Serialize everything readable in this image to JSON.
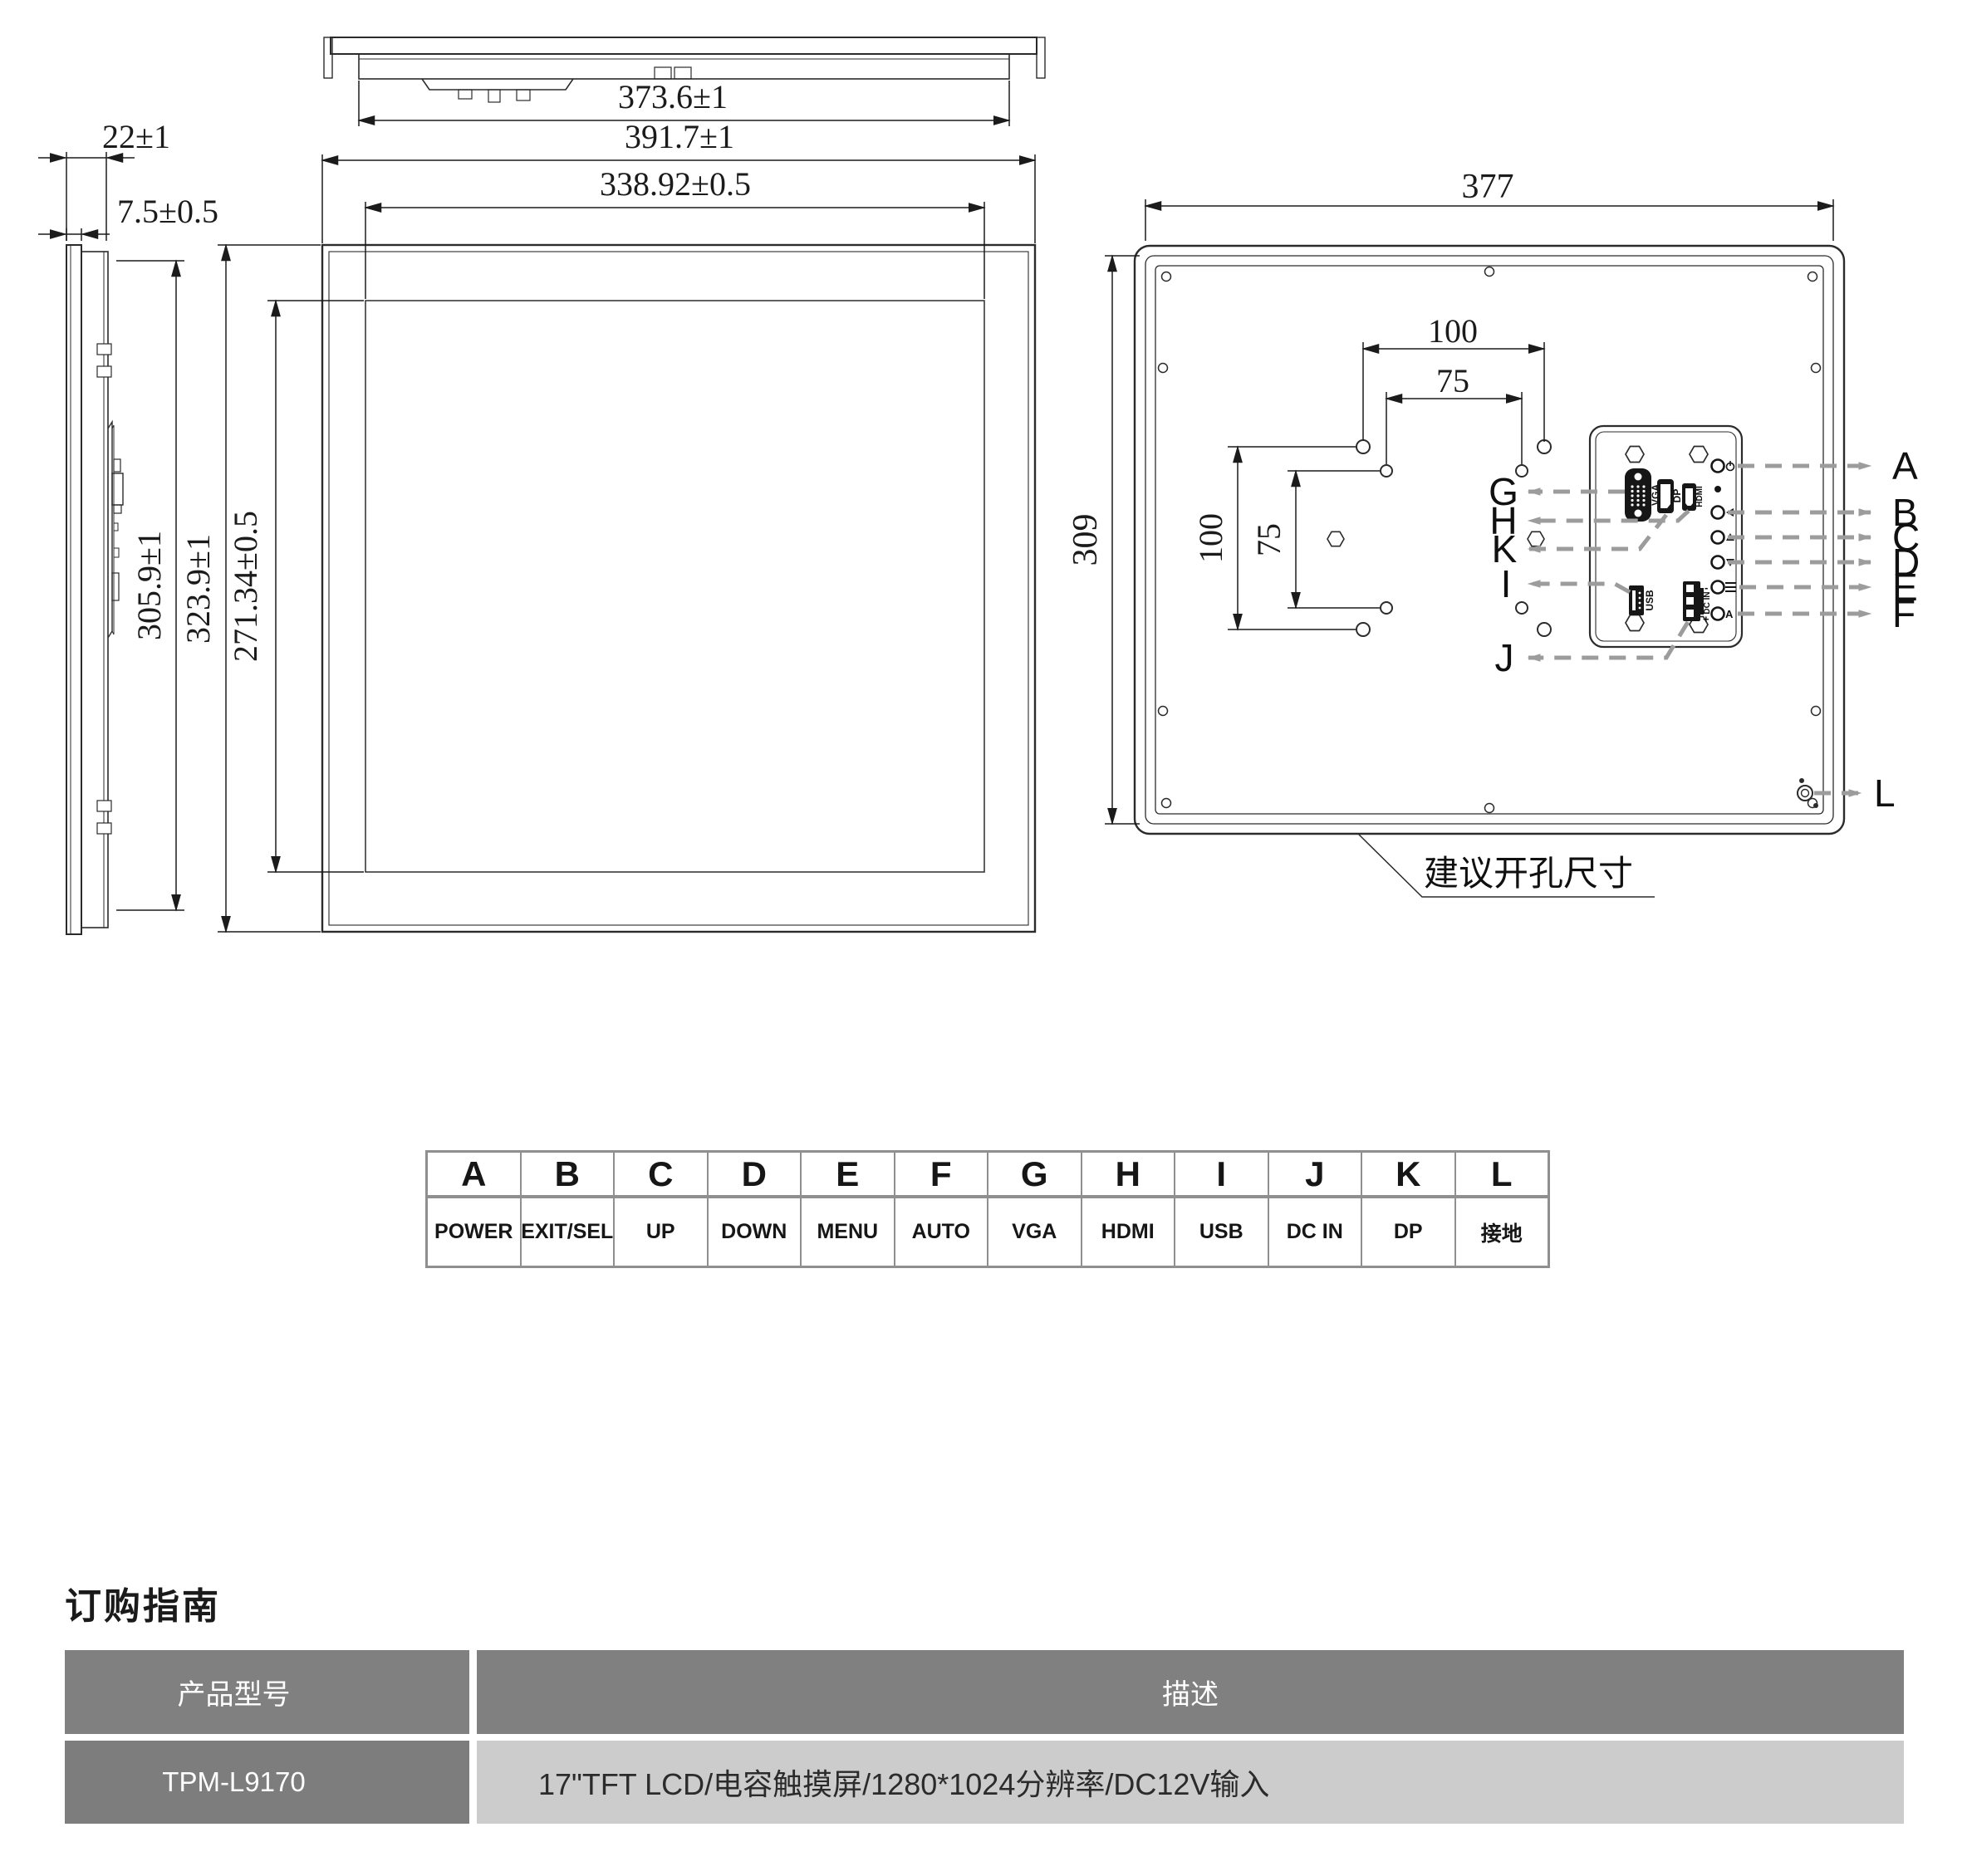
{
  "drawing": {
    "dims": {
      "top_width": "373.6±1",
      "outer_width": "391.7±1",
      "active_width": "338.92±0.5",
      "thickness": "22±1",
      "bezel_thickness": "7.5±0.5",
      "side_height": "305.9±1",
      "outer_height": "323.9±1",
      "active_height": "271.34±0.5",
      "cutout_width": "377",
      "cutout_height": "309",
      "vesa_h_100": "100",
      "vesa_h_75": "75",
      "vesa_v_100": "100",
      "vesa_v_75": "75"
    },
    "ports": {
      "vga": "VGA",
      "dp": "DP",
      "hdmi": "HDMI",
      "usb": "USB",
      "dc_in": "DC IN",
      "plus": "+",
      "minus": "-",
      "auto_marker": "A"
    },
    "callouts": {
      "right": [
        "A",
        "B",
        "C",
        "D",
        "E",
        "F"
      ],
      "left": [
        "G",
        "H",
        "K",
        "I",
        "J"
      ],
      "ground": "L"
    },
    "cutout_note": "建议开孔尺寸"
  },
  "legend": {
    "entries": [
      {
        "letter": "A",
        "label": "POWER"
      },
      {
        "letter": "B",
        "label": "EXIT/SEL"
      },
      {
        "letter": "C",
        "label": "UP"
      },
      {
        "letter": "D",
        "label": "DOWN"
      },
      {
        "letter": "E",
        "label": "MENU"
      },
      {
        "letter": "F",
        "label": "AUTO"
      },
      {
        "letter": "G",
        "label": "VGA"
      },
      {
        "letter": "H",
        "label": "HDMI"
      },
      {
        "letter": "I",
        "label": "USB"
      },
      {
        "letter": "J",
        "label": "DC IN"
      },
      {
        "letter": "K",
        "label": "DP"
      },
      {
        "letter": "L",
        "label": "接地"
      }
    ]
  },
  "ordering": {
    "title": "订购指南",
    "col_model": "产品型号",
    "col_desc": "描述",
    "model": "TPM-L9170",
    "description": "17\"TFT LCD/电容触摸屏/1280*1024分辨率/DC12V输入"
  },
  "colors": {
    "line": "#2b2b2b",
    "leader": "#9c9c9c",
    "table_header_bg": "#808080",
    "table_row_bg": "#7d7d7d",
    "table_desc_bg": "#cccccc"
  }
}
